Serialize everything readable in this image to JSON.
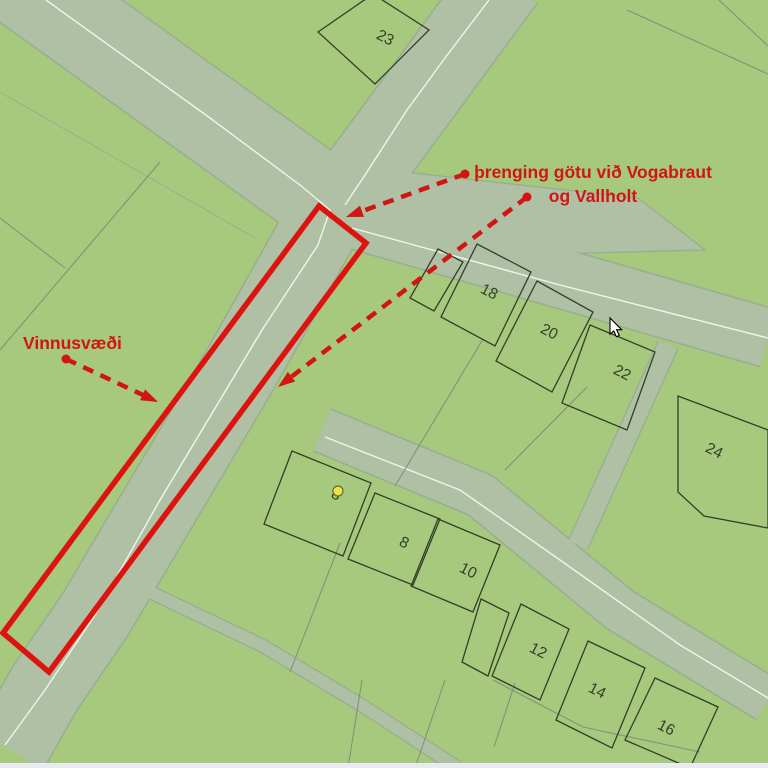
{
  "map": {
    "colors": {
      "background": "#a7c97d",
      "road_fill": "#afc0a4",
      "road_edge": "#99ad90",
      "centerline": "#f0f5ec",
      "boundary": "#7e947a",
      "building_stroke": "#333f2a",
      "label_color": "#333f2a",
      "annotation_red": "#d21510",
      "work_area_red": "#dd1310",
      "marker_yellow": "#e8e44c",
      "marker_outline": "#6a6a28",
      "bottom_strip": "#e8ebf2"
    },
    "roads": [
      {
        "name": "road-northwest",
        "pts": [
          [
            -10,
            -40
          ],
          [
            335,
            208
          ]
        ],
        "width": 88
      },
      {
        "name": "road-north",
        "pts": [
          [
            505,
            -20
          ],
          [
            338,
            207
          ]
        ],
        "width": 78
      },
      {
        "name": "road-south-main",
        "pts": [
          [
            332,
            206
          ],
          [
            240,
            370
          ],
          [
            95,
            615
          ],
          [
            45,
            688
          ],
          [
            10,
            750
          ]
        ],
        "width": 76
      },
      {
        "name": "road-east-vallholt",
        "pts": [
          [
            340,
            215
          ],
          [
            768,
            338
          ]
        ],
        "width": 58
      },
      {
        "name": "road-southeast",
        "pts": [
          [
            322,
            430
          ],
          [
            480,
            495
          ],
          [
            620,
            610
          ],
          [
            768,
            700
          ]
        ],
        "width": 44
      }
    ],
    "road_polygons": [
      {
        "name": "road-widening-stub",
        "points": [
          [
            368,
            168
          ],
          [
            638,
            198
          ],
          [
            705,
            250
          ],
          [
            395,
            258
          ]
        ]
      }
    ],
    "minor_paths": [
      {
        "name": "footpath-bottom",
        "pts": [
          [
            150,
            592
          ],
          [
            263,
            646
          ],
          [
            363,
            706
          ],
          [
            458,
            768
          ]
        ],
        "width": 12
      },
      {
        "name": "connector-path",
        "pts": [
          [
            668,
            345
          ],
          [
            578,
            545
          ]
        ],
        "width": 20
      }
    ],
    "inner_lines": [
      {
        "pts": [
          [
            0,
            92
          ],
          [
            255,
            238
          ]
        ]
      }
    ],
    "centerlines": [
      {
        "pts": [
          [
            46,
            0
          ],
          [
            210,
            118
          ],
          [
            300,
            185
          ],
          [
            330,
            210
          ],
          [
            318,
            245
          ],
          [
            262,
            330
          ],
          [
            160,
            500
          ],
          [
            95,
            615
          ],
          [
            45,
            690
          ],
          [
            5,
            745
          ]
        ]
      },
      {
        "pts": [
          [
            489,
            0
          ],
          [
            445,
            58
          ],
          [
            407,
            110
          ],
          [
            365,
            175
          ],
          [
            345,
            205
          ]
        ]
      },
      {
        "pts": [
          [
            352,
            228
          ],
          [
            560,
            285
          ],
          [
            768,
            338
          ]
        ]
      },
      {
        "pts": [
          [
            325,
            437
          ],
          [
            460,
            490
          ],
          [
            560,
            560
          ],
          [
            680,
            645
          ],
          [
            768,
            698
          ]
        ]
      }
    ],
    "boundaries": [
      {
        "pts": [
          [
            0,
            218
          ],
          [
            65,
            268
          ]
        ]
      },
      {
        "pts": [
          [
            160,
            162
          ],
          [
            0,
            350
          ]
        ]
      },
      {
        "pts": [
          [
            627,
            10
          ],
          [
            768,
            74
          ]
        ]
      },
      {
        "pts": [
          [
            719,
            0
          ],
          [
            768,
            46
          ]
        ]
      },
      {
        "pts": [
          [
            483,
            339
          ],
          [
            395,
            486
          ]
        ]
      },
      {
        "pts": [
          [
            587,
            387
          ],
          [
            505,
            470
          ]
        ]
      },
      {
        "pts": [
          [
            340,
            543
          ],
          [
            290,
            672
          ]
        ]
      },
      {
        "pts": [
          [
            362,
            680
          ],
          [
            348,
            768
          ]
        ]
      },
      {
        "pts": [
          [
            445,
            680
          ],
          [
            415,
            768
          ]
        ]
      },
      {
        "pts": [
          [
            515,
            683
          ],
          [
            494,
            747
          ]
        ]
      },
      {
        "pts": [
          [
            493,
            680
          ],
          [
            583,
            727
          ],
          [
            700,
            752
          ]
        ]
      }
    ],
    "buildings": [
      {
        "number": "23",
        "points": [
          [
            318,
            32
          ],
          [
            373,
            -6
          ],
          [
            429,
            30
          ],
          [
            375,
            84
          ]
        ],
        "label": [
          383,
          42
        ]
      },
      {
        "number": "",
        "points": [
          [
            438,
            249
          ],
          [
            463,
            262
          ],
          [
            434,
            311
          ],
          [
            410,
            298
          ]
        ],
        "label": null
      },
      {
        "number": "18",
        "points": [
          [
            477,
            244
          ],
          [
            531,
            272
          ],
          [
            495,
            346
          ],
          [
            441,
            317
          ]
        ],
        "label": [
          487,
          296
        ]
      },
      {
        "number": "20",
        "points": [
          [
            537,
            281
          ],
          [
            593,
            312
          ],
          [
            552,
            392
          ],
          [
            496,
            361
          ]
        ],
        "label": [
          547,
          336
        ]
      },
      {
        "number": "22",
        "points": [
          [
            590,
            325
          ],
          [
            655,
            352
          ],
          [
            627,
            430
          ],
          [
            562,
            403
          ]
        ],
        "label": [
          620,
          377
        ]
      },
      {
        "number": "24",
        "points": [
          [
            678,
            396
          ],
          [
            768,
            430
          ],
          [
            768,
            528
          ],
          [
            704,
            516
          ],
          [
            678,
            492
          ]
        ],
        "label": [
          712,
          455
        ]
      },
      {
        "number": "8",
        "points": [
          [
            292,
            451
          ],
          [
            371,
            483
          ],
          [
            343,
            556
          ],
          [
            264,
            524
          ]
        ],
        "label": [
          334,
          499
        ]
      },
      {
        "number": "8",
        "points": [
          [
            375,
            493
          ],
          [
            440,
            519
          ],
          [
            413,
            585
          ],
          [
            348,
            559
          ]
        ],
        "label": [
          402,
          547
        ]
      },
      {
        "number": "10",
        "points": [
          [
            438,
            519
          ],
          [
            500,
            545
          ],
          [
            473,
            612
          ],
          [
            411,
            586
          ]
        ],
        "label": [
          466,
          575
        ]
      },
      {
        "number": "",
        "points": [
          [
            481,
            599
          ],
          [
            509,
            613
          ],
          [
            488,
            676
          ],
          [
            462,
            662
          ]
        ],
        "label": null
      },
      {
        "number": "12",
        "points": [
          [
            521,
            604
          ],
          [
            569,
            629
          ],
          [
            540,
            700
          ],
          [
            492,
            676
          ]
        ],
        "label": [
          536,
          655
        ]
      },
      {
        "number": "14",
        "points": [
          [
            588,
            641
          ],
          [
            645,
            668
          ],
          [
            612,
            748
          ],
          [
            556,
            720
          ]
        ],
        "label": [
          595,
          695
        ]
      },
      {
        "number": "16",
        "points": [
          [
            655,
            678
          ],
          [
            718,
            707
          ],
          [
            690,
            768
          ],
          [
            625,
            740
          ]
        ],
        "label": [
          664,
          732
        ]
      }
    ],
    "label_rotation_deg": 27,
    "work_area": {
      "points": [
        [
          319,
          206
        ],
        [
          366,
          243
        ],
        [
          49,
          672
        ],
        [
          3,
          633
        ]
      ],
      "stroke_width": 5.5
    },
    "arrows": [
      {
        "from": [
          465,
          174
        ],
        "to": [
          346,
          217
        ]
      },
      {
        "from": [
          527,
          197
        ],
        "to": [
          278,
          387
        ]
      },
      {
        "from": [
          66,
          359
        ],
        "to": [
          158,
          402
        ]
      }
    ],
    "annotations": {
      "street_note_line1": "þrenging götu við Vogabraut",
      "street_note_line2": "og Vallholt",
      "street_note_pos": {
        "x": 593,
        "y1": 178,
        "y2": 202
      },
      "work_area_label": "Vinnusvæði",
      "work_area_label_pos": {
        "x": 23,
        "y": 349
      }
    },
    "address_marker": {
      "x": 338,
      "y": 491,
      "r": 5
    },
    "cursor": {
      "x": 610,
      "y": 318
    }
  }
}
